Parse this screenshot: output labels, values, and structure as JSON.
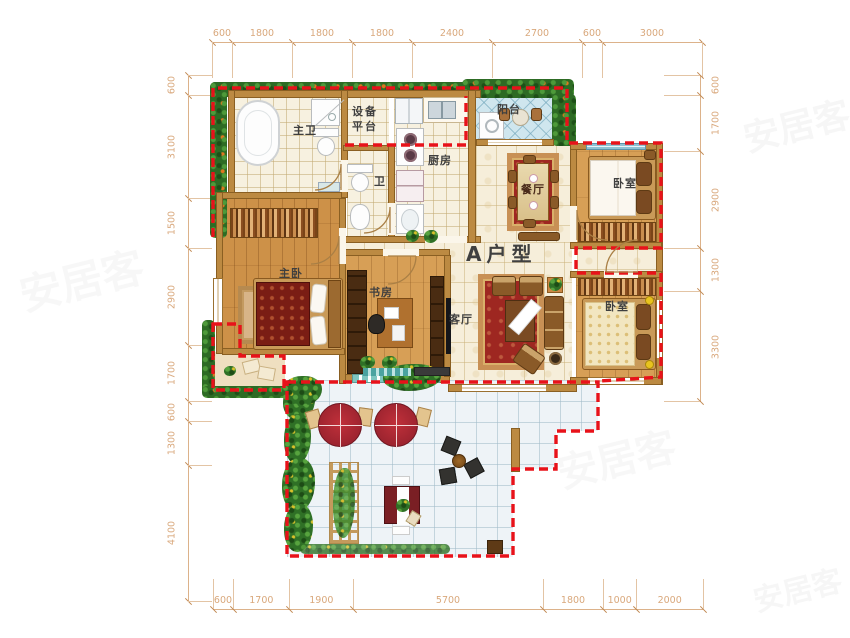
{
  "title": "A户型",
  "watermark": "安居客",
  "colors": {
    "boundary_red": "#e8121a",
    "dimension_text": "#d9a87c",
    "wall": "#bc8a42",
    "hedge_green": "#2d6b24",
    "wood_floor": "#d79f56",
    "hall_tile": "#f6eeda",
    "balcony_tile": "#cfe6ee",
    "terrace_tile": "#eef3f7"
  },
  "rooms": [
    {
      "id": "master-bath",
      "label": "主卫"
    },
    {
      "id": "equipment-platform",
      "label": "设备平台",
      "lines": [
        "设备",
        "平台"
      ]
    },
    {
      "id": "kitchen",
      "label": "厨房"
    },
    {
      "id": "bath",
      "label": "卫"
    },
    {
      "id": "balcony",
      "label": "阳台"
    },
    {
      "id": "dining-room",
      "label": "餐厅"
    },
    {
      "id": "bedroom-top",
      "label": "卧室"
    },
    {
      "id": "master-bedroom",
      "label": "主卧"
    },
    {
      "id": "study",
      "label": "书房"
    },
    {
      "id": "living-room",
      "label": "客厅"
    },
    {
      "id": "bedroom-bottom",
      "label": "卧室"
    }
  ],
  "dimensions": {
    "top": [
      "600",
      "1800",
      "1800",
      "1800",
      "2400",
      "2700",
      "600",
      "3000"
    ],
    "bottom": [
      "600",
      "1700",
      "1900",
      "5700",
      "1800",
      "1000",
      "2000"
    ],
    "left": [
      "600",
      "3100",
      "1500",
      "2900",
      "1700",
      "600",
      "1300",
      "4100"
    ],
    "right": [
      "600",
      "1700",
      "2900",
      "1300",
      "3300"
    ]
  }
}
